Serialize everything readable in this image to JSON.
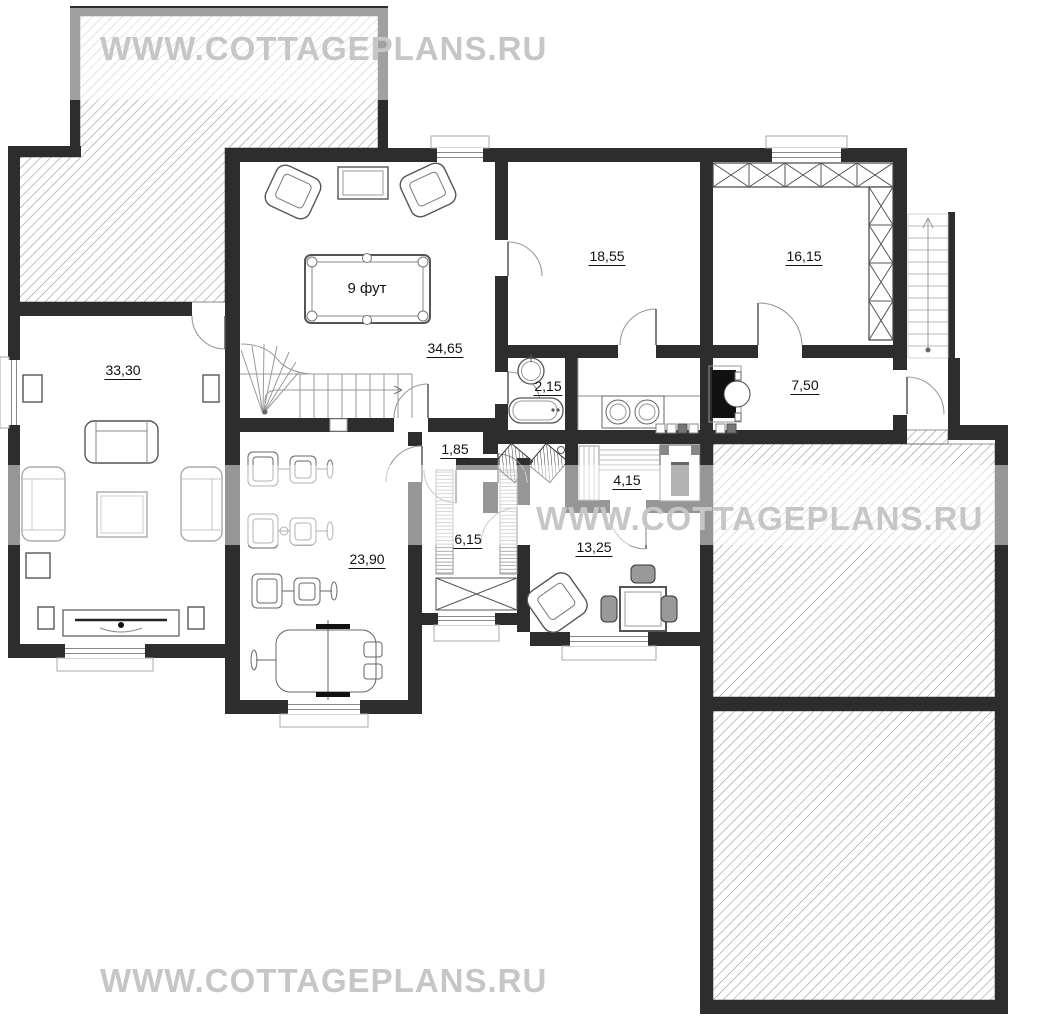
{
  "watermark": {
    "text": "WWW.COTTAGEPLANS.RU"
  },
  "rooms": {
    "living_room": {
      "area": "33,30"
    },
    "billiard_room": {
      "area": "34,65"
    },
    "room_18": {
      "area": "18,55"
    },
    "room_16": {
      "area": "16,15"
    },
    "bathroom": {
      "area": "2,15"
    },
    "hall": {
      "area": "7,50"
    },
    "corridor": {
      "area": "1,85"
    },
    "sauna": {
      "area": "4,15"
    },
    "entry": {
      "area": "6,15"
    },
    "gym": {
      "area": "23,90"
    },
    "lounge": {
      "area": "13,25"
    }
  },
  "billiard_table": {
    "label": "9 фут"
  },
  "colors": {
    "wall": "#2d2d2d",
    "watermark_gray": "#c6c6c6",
    "hatch_line": "#8f8f8f"
  }
}
